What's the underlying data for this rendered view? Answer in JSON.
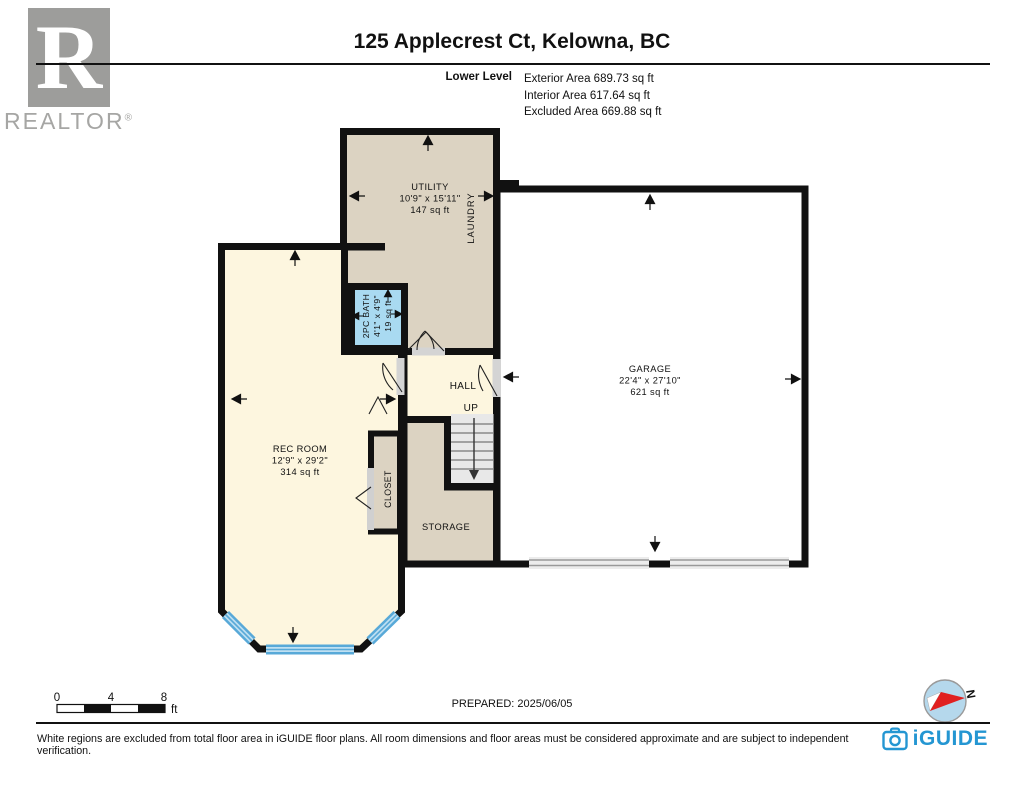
{
  "header": {
    "brand_r": "R",
    "brand": "REALTOR",
    "brand_reg": "®",
    "title": "125 Applecrest Ct, Kelowna, BC",
    "level_label": "Lower Level",
    "areas": [
      "Exterior Area 689.73 sq ft",
      "Interior Area 617.64 sq ft",
      "Excluded Area 669.88 sq ft"
    ]
  },
  "rooms": {
    "utility": {
      "name": "UTILITY",
      "dims": "10'9\" x 15'11\"",
      "area": "147 sq ft"
    },
    "laundry": {
      "name": "LAUNDRY"
    },
    "bath": {
      "name": "2PC BATH",
      "dims": "4'1\" x 4'9\"",
      "area": "19 sq ft"
    },
    "hall": {
      "name": "HALL"
    },
    "stairs": {
      "label": "UP"
    },
    "rec": {
      "name": "REC ROOM",
      "dims": "12'9\" x 29'2\"",
      "area": "314 sq ft"
    },
    "closet": {
      "name": "CLOSET"
    },
    "storage": {
      "name": "STORAGE"
    },
    "garage": {
      "name": "GARAGE",
      "dims": "22'4\" x 27'10\"",
      "area": "621 sq ft"
    }
  },
  "scale": {
    "start": "0",
    "mid": "4",
    "end": "8",
    "unit": "ft"
  },
  "compass": {
    "north": "N"
  },
  "prepared": "PREPARED: 2025/06/05",
  "footer": {
    "disclaimer": "White regions are excluded from total floor area in iGUIDE floor plans. All room dimensions and floor areas must be considered approximate and are subject to independent verification.",
    "brand": "iGUIDE"
  },
  "colors": {
    "wall": "#111111",
    "room_tan": "#dcd3c2",
    "room_yellow": "#fdf6df",
    "room_bath_blue": "#a9daf1",
    "stairs_gray": "#e8e8e8",
    "window_blue": "#58a9d8",
    "opening_gray": "#d4d4d4",
    "realtor_gray": "#9d9d9b",
    "iguide_blue": "#2496d2",
    "compass_fill": "#b5d8ec"
  }
}
